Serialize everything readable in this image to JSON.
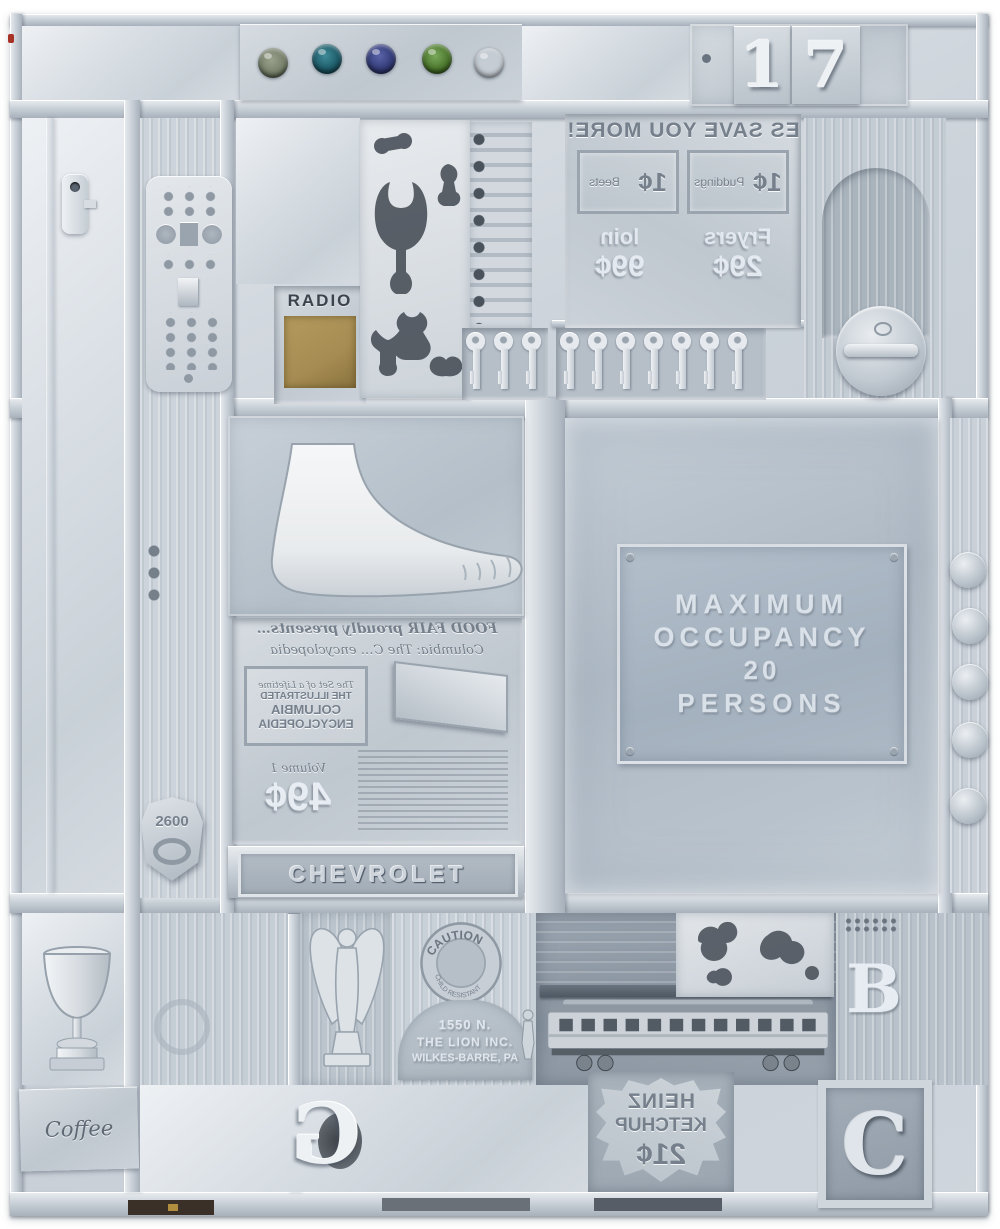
{
  "palette": {
    "background": "#ffffff",
    "base_gray": "#cbd2d9",
    "highlight": "#eef1f4",
    "shadow": "#8d97a2",
    "deep_shadow": "#4e5660",
    "brass": "#a68c52",
    "red_speck": "#a83226"
  },
  "top_band": {
    "number_plate": "17",
    "gem_count": 5,
    "gem_colors": [
      "#76806a",
      "#1d5a68",
      "#333c78",
      "#4a762c",
      "#275247"
    ]
  },
  "plates": {
    "grocery": {
      "mirrored": true,
      "headline": "ES SAVE YOU MORE!",
      "coupon1_label": "Puddings",
      "coupon1_price": "1¢",
      "coupon2_label": "Beets",
      "coupon2_price": "1¢",
      "item1": "Fryers",
      "item1_price": "29¢",
      "item2": "loin",
      "item2_price": "99¢"
    },
    "radio_label": "RADIO",
    "occupancy": {
      "line1": "MAXIMUM",
      "line2": "OCCUPANCY",
      "line3": "20",
      "line4": "PERSONS"
    },
    "encyclopedia": {
      "mirrored": true,
      "script_line1": "FOOD FAIR proudly presents…",
      "script_line2": "Columbia: The C… encyclopedia",
      "box_line1": "The Set of a Lifetime",
      "box_line2": "THE ILLUSTRATED",
      "box_line3": "COLUMBIA",
      "box_line4": "ENCYCLOPEDIA",
      "price_note": "Volume 1",
      "price": "49¢"
    },
    "chevrolet": "CHEVROLET",
    "badge_number": "2600",
    "coffee": "Coffee",
    "caution_top": "CAUTION",
    "caution_bottom": "CHILD RESISTANT",
    "lion": {
      "line1": "1550 N.",
      "line2": "THE LION INC.",
      "line3": "WILKES-BARRE, PA"
    },
    "heinz": {
      "mirrored": true,
      "line1": "HEINZ",
      "line2": "KETCHUP",
      "price": "21¢"
    },
    "letter_b": "B",
    "letter_c": "C",
    "letter_g": "G"
  },
  "objects": {
    "remote_control": "tv-remote",
    "metal_clip": "metal-clip",
    "stencil_panel": "die-cut-stencil-panel",
    "keys_left_count": 3,
    "keys_right_count": 7,
    "arched_panel": "arched-wood-panel",
    "gas_cap": "round-gas-cap",
    "mannequin_foot": "mannequin-foot",
    "shield_badge": "shield-badge",
    "right_knob_count": 5,
    "trophy": "loving-cup-trophy",
    "angel": "winged-figurine",
    "train": "model-passenger-car",
    "train_window_count": 12,
    "person_figurine": "person-figurine",
    "puzzle_panel": "puzzle-cutout-panel"
  }
}
